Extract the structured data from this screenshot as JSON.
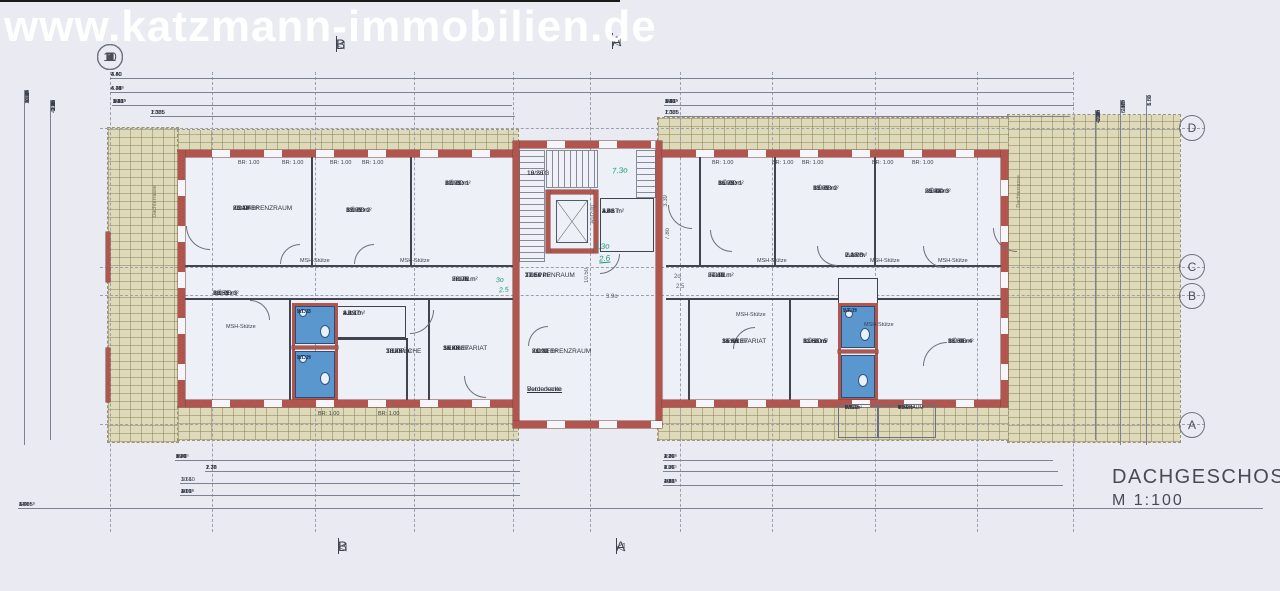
{
  "watermark": "www.katzmann-immobilien.de",
  "title_block": {
    "title": "DACHGESCHOSS",
    "scale": "M 1:100"
  },
  "grid": {
    "columns": [
      "1",
      "2",
      "3",
      "4",
      "5",
      "6",
      "7",
      "8",
      "9",
      "10",
      "11"
    ],
    "rows": [
      "D",
      "C",
      "B",
      "A"
    ]
  },
  "section_markers": {
    "top_b": "B",
    "top_a": "A",
    "bottom_b": "B",
    "bottom_a": "A"
  },
  "small_labels": {
    "br": "BR: 1.00",
    "msh": "MSH-Stütze",
    "terrace": "Dachterrasse",
    "stairs_line1": "19 STG",
    "stairs_line2": "18/26",
    "elevator": "Aufzug",
    "front_edge_1": "Vorderkante",
    "front_edge_2": "Betondecke",
    "stair_dim_h": "10.50",
    "stair_dim_v": "3.39"
  },
  "annotations": {
    "green_1": "7.3o",
    "green_2": "7.3o",
    "green_3": "2.6",
    "green_4": "3o",
    "green_5": "2.5",
    "pencil_1": "7.8o",
    "pencil_2": "3.9o",
    "pencil_3": "2o",
    "pencil_4": "2.5"
  },
  "rooms": {
    "r3104": {
      "id": "3.1.04",
      "name": "KONFERENZRAUM",
      "area": "25.43 m²",
      "perim": "20.24 m"
    },
    "r3103": {
      "id": "3.1.03",
      "name": "BÜRO 2",
      "area": "19.97 m²",
      "perim": "17.89 m"
    },
    "r3102": {
      "id": "3.1.02",
      "name": "BÜRO 1",
      "area": "20.21 m²",
      "perim": "17.99 m"
    },
    "r3105": {
      "id": "3.1.05",
      "name": "BÜRO 3",
      "area": "20.59 m²",
      "perim": "18.51 m"
    },
    "r3101": {
      "id": "3.1.01",
      "name": "FLUR",
      "area": "22.01 m²",
      "perim": "36.76 m"
    },
    "r3110": {
      "id": "3.1.10",
      "name": "ABST.",
      "area": "4.29 m²",
      "perim": "8.82 m"
    },
    "r3107": {
      "id": "3.1.07",
      "name": "TEEKÜCHE",
      "area": "10.49 m²",
      "perim": "13.29 m"
    },
    "r3106": {
      "id": "3.1.06",
      "name": "SEKRETARIAT",
      "area": "14.89 m²",
      "perim": "15.46 m"
    },
    "r3111": {
      "id": "3.1.11",
      "name": "KONFERENZRAUM",
      "area": "26.91 m²",
      "perim": "21.29 m"
    },
    "r3108": {
      "id": "3.1.08",
      "name": "WC-D"
    },
    "r3109": {
      "id": "3.1.09",
      "name": "WC-H"
    },
    "r301": {
      "id": "3.01",
      "name": "TREPPENRAUM",
      "area": "17.50 m²",
      "perim": "21.61 m"
    },
    "r302": {
      "id": "3.02",
      "name": "ABST.",
      "area": "4.41 m²",
      "perim": "3.46 m"
    },
    "r3202": {
      "id": "3.2.02",
      "name": "BÜRO 1",
      "area": "16.73 m²",
      "perim": "16.39 m"
    },
    "r3203": {
      "id": "3.2.03",
      "name": "BÜRO 2",
      "area": "19.97 m²",
      "perim": "17.89 m"
    },
    "r3204": {
      "id": "3.2.04",
      "name": "BÜRO 3",
      "area": "25.43 m²",
      "perim": "20.24 m"
    },
    "r3201": {
      "id": "3.2.01",
      "name": "FLUR",
      "area": "27.41 m²",
      "perim": "34.60 m"
    },
    "r3206": {
      "id": "3.2.06",
      "name": "GARD.",
      "area": "2.08 m²",
      "perim": "7.18 m"
    },
    "r3211": {
      "id": "3.2.11",
      "name": "SEKRETARIAT",
      "area": "14.66 m²",
      "perim": "15.44 m"
    },
    "r3210": {
      "id": "3.2.10",
      "name": "BÜRO 5",
      "area": "11.00 m²",
      "perim": "13.56 m"
    },
    "r3205": {
      "id": "3.2.05",
      "name": "BÜRO 4",
      "area": "17.30 m²",
      "perim": "16.64 m"
    },
    "r3209": {
      "id": "3.2.09",
      "name": "WC-H"
    },
    "r3208": {
      "id": "3.2.08",
      "name": "WC/D",
      "area": "2.56 m²",
      "perim": "6.37 m"
    },
    "r3207": {
      "id": "3.2.07",
      "name": "VORRAUM",
      "area": "4.03 m²",
      "perim": "9.74 m"
    }
  },
  "dimensions": {
    "top1": [
      "4.40",
      "4.40",
      "4.40",
      "4.40",
      "3.50",
      "3.50",
      "4.40",
      "4.40",
      "4.40",
      "4.40"
    ],
    "top2": [
      "4.41⁵",
      "4.30",
      "4.30",
      "4.35",
      "6.44",
      "4.35",
      "4.30",
      "4.30",
      "4.41⁵"
    ],
    "top3_left": [
      "3.06⁵",
      "2.41",
      "1.13⁵",
      "30",
      "1.13⁵",
      "97",
      "1.13⁵",
      "30",
      "1.13⁵",
      "2.63",
      "1.13⁵",
      "1.03",
      "1.01"
    ],
    "top3_right": [
      "1.01",
      "1.03",
      "1.13⁵",
      "2.63",
      "1.13⁵",
      "30",
      "1.13⁵",
      "97",
      "1.13⁵",
      "30",
      "1.13⁵",
      "2.41",
      "17⁵",
      "3.06⁵"
    ],
    "top4_left": [
      "17⁵",
      "1.135",
      "1.135",
      "1.135",
      "1.135",
      "1.135",
      "2.30"
    ],
    "top4_right": [
      "2.30",
      "1.135",
      "1.135",
      "1.135",
      "1.135",
      "1.135",
      "17⁵"
    ],
    "bottom1_left": [
      "27⁵",
      "1.27",
      "1.26",
      "3.20⁵",
      "1.26",
      "2.30",
      "1.26",
      "69⁵",
      "1.26",
      "90",
      "1.01"
    ],
    "bottom1_right": [
      "2.17",
      "1.26",
      "2.19⁵",
      "1.26",
      "49",
      "1.26",
      "3.00⁵",
      "1.26",
      "1.70"
    ],
    "bottom2_left": [
      "2.76",
      "1.1⁹",
      "1.76",
      "2.76",
      "2.76",
      "2.30"
    ],
    "bottom2_right": [
      "4.35",
      "2.76",
      "2.76",
      "1.76",
      "9.97⁵",
      "2.76",
      "17⁵"
    ],
    "bottom3_left": [
      "3.61",
      "10.60"
    ],
    "bottom3_right": [
      "4.35",
      "2.68⁵",
      "10",
      "1.51⁵",
      "10",
      "1.15",
      "10",
      "4.22⁵",
      "17⁵",
      "10"
    ],
    "bottom4_left": [
      "3.61",
      "10",
      "1.00",
      "10",
      "1.51⁵",
      "20",
      "4.06⁵",
      "10",
      "3.63⁵"
    ],
    "bottom_total": [
      "17⁵",
      "3.06⁵",
      "14.85⁵",
      "6.49",
      "14.85⁵",
      "3.06⁵",
      "17⁵"
    ],
    "left_v1": [
      "1.27⁵",
      "1.10",
      "4.64⁵",
      "10.94",
      "5.64⁵",
      "2.58",
      "1.10",
      "1.27⁵"
    ],
    "left_v2": [
      "1.10",
      "10",
      "4.64⁵",
      "3.31",
      "1.26",
      "2.76",
      "1.45",
      "1.93",
      "2.33",
      "1.42",
      "2.76",
      "1.26",
      "1.10"
    ],
    "right_v1": [
      "1.10",
      "10",
      "4.64⁵",
      "2.76",
      "1.65",
      "1.45",
      "2.76",
      "4.09⁵",
      "17⁵"
    ],
    "right_v2": [
      "17⁵",
      "1.10",
      "6.01⁵",
      "1.45",
      "5.47⁵",
      "10"
    ],
    "right_v3": [
      "6.00",
      "1.50",
      "5.51"
    ]
  },
  "colors": {
    "wall_red": "#b2554e",
    "wc_blue": "#5b97cf",
    "terrace_tan": "#ded9b9",
    "annotation_green": "#169a72"
  }
}
